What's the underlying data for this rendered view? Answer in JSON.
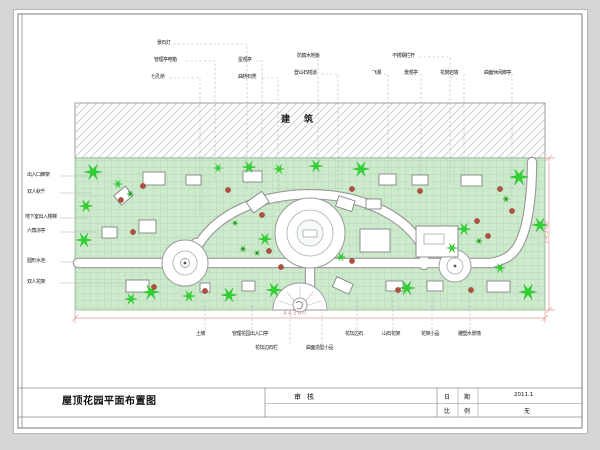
{
  "sheet": {
    "building_label": "建筑",
    "plan_title": "屋顶花园平面布置图",
    "review_label": "审核",
    "table": {
      "date_label_1": "日",
      "date_label_2": "期",
      "date_value": "2011.1",
      "scale_label_1": "比",
      "scale_label_2": "例",
      "scale_value": "无"
    },
    "dims": {
      "bottom": "44300",
      "right": "14300"
    }
  },
  "callouts": {
    "top": [
      {
        "label": "景石灯"
      },
      {
        "label": "管理亭电箱"
      },
      {
        "label": "七孔桥"
      },
      {
        "label": "星观亭"
      },
      {
        "label": "曲桥石凳"
      },
      {
        "label": "防腐木地板"
      },
      {
        "label": "登山石栈道"
      },
      {
        "label": "不锈钢栏杆"
      },
      {
        "label": "飞瀑"
      },
      {
        "label": "景观亭"
      },
      {
        "label": "花岗岩墙"
      },
      {
        "label": "曲面休闲廊亭"
      }
    ],
    "left": [
      {
        "label": "出入口廊架"
      },
      {
        "label": "双人秋千"
      },
      {
        "label": "地下室出入楼梯"
      },
      {
        "label": "六角凉亭"
      },
      {
        "label": "圆形水池"
      },
      {
        "label": "双人花架"
      }
    ],
    "bottom": [
      {
        "label": "土坡"
      },
      {
        "label": "管理花园出入口亭"
      },
      {
        "label": "花坛边石"
      },
      {
        "label": "山石花架"
      },
      {
        "label": "花架小品"
      },
      {
        "label": "雕塑水景墙"
      }
    ],
    "bottom2": [
      {
        "label": "花坛边石栏"
      },
      {
        "label": "曲面造型小品"
      }
    ]
  },
  "colors": {
    "lawn": "#cdeacd",
    "lawn_grid": "#b9dcb9",
    "tree": "#2fd32f",
    "shrub": "#b15040",
    "dimension": "#e09a9a",
    "path_edge": "#999999"
  }
}
